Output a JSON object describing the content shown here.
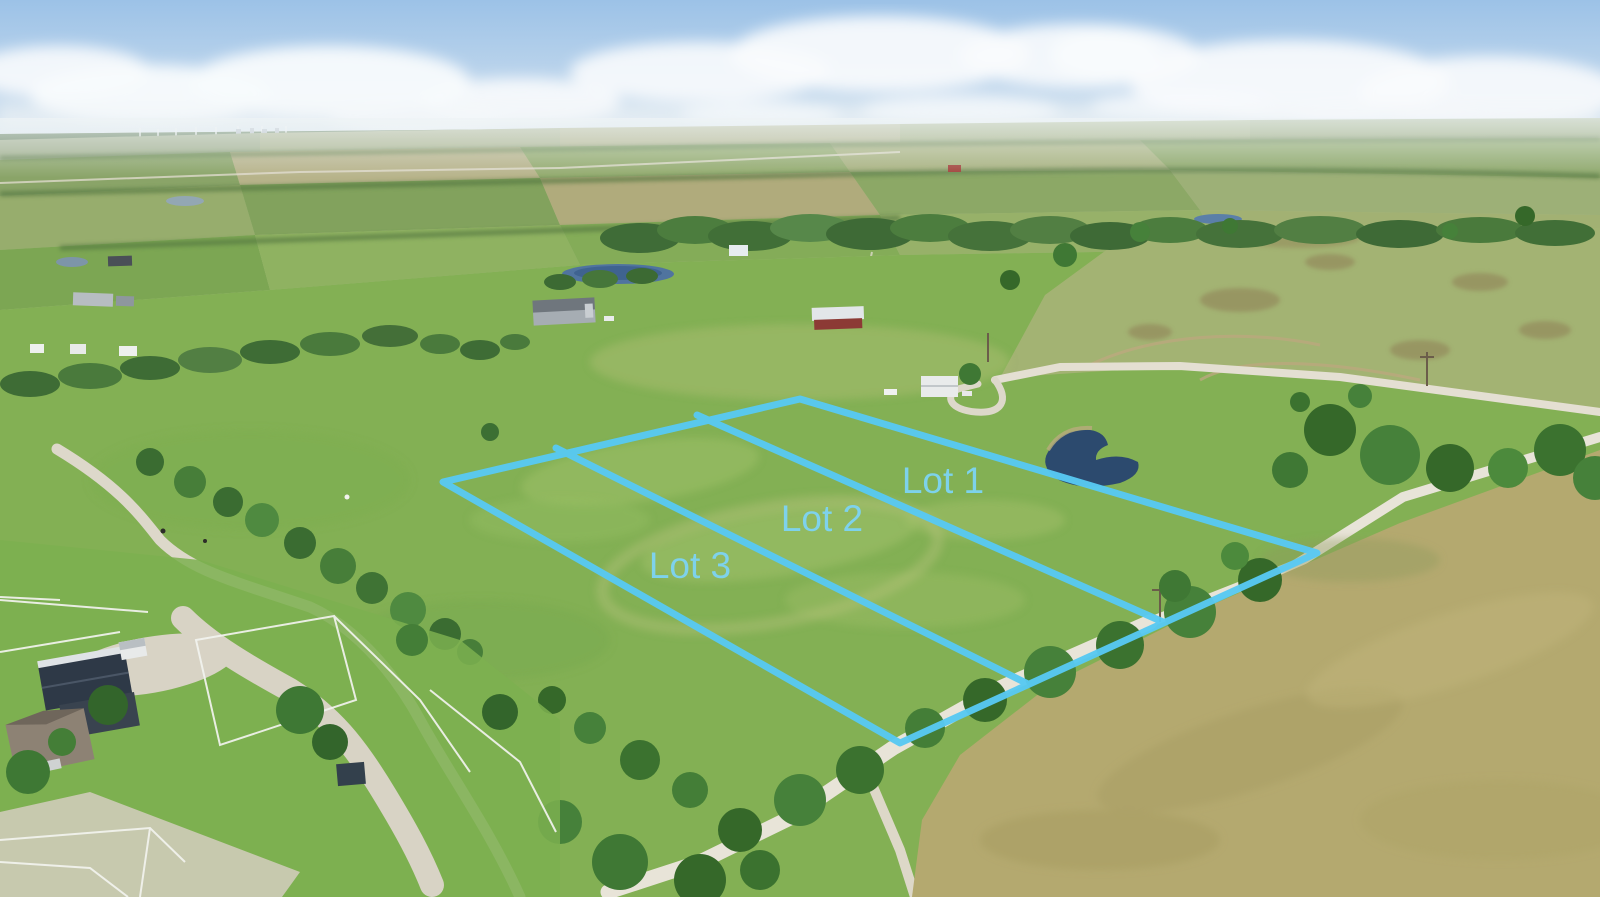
{
  "scene": {
    "description": "Aerial drone photograph of rural acreage listing with three surveyed lots outlined in light blue over green pasture",
    "features": "country gravel roads, ranch with white horse fencing and barns, ponds, tree lines, distant horizon with wind turbines"
  },
  "overlay": {
    "line_color": "#58c9f3",
    "label_color": "#7dd4f2",
    "lots": [
      {
        "label": "Lot 1"
      },
      {
        "label": "Lot 2"
      },
      {
        "label": "Lot 3"
      }
    ]
  },
  "palette": {
    "sky_top": "#9cc2e7",
    "cloud": "#f8fbfd",
    "pasture_green": "#86b157",
    "dry_field_tan": "#b4a96f",
    "gravel_road": "#e8e4d8",
    "pond_blue": "#2c4a6e",
    "tree_green": "#3e7334"
  }
}
